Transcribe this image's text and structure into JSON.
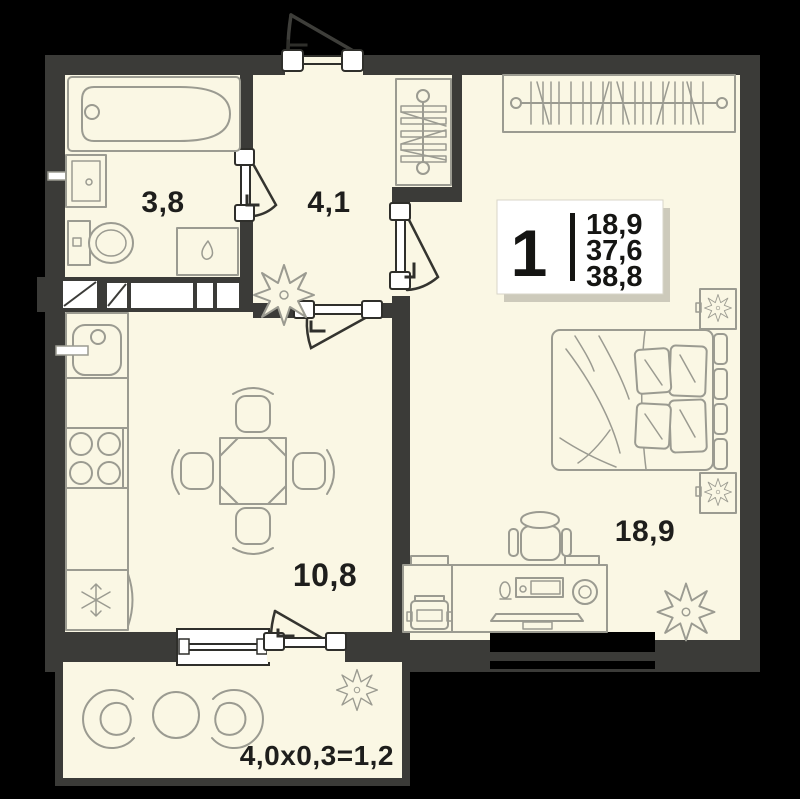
{
  "rooms": {
    "bathroom": {
      "name": "bathroom",
      "area": "3,8"
    },
    "hallway": {
      "name": "hallway",
      "area": "4,1"
    },
    "kitchen_living": {
      "name": "kitchen-living-room",
      "area": "10,8"
    },
    "bedroom": {
      "name": "bedroom",
      "area": "18,9"
    }
  },
  "balcony": {
    "dimensions_label": "4,0x0,3=1,2"
  },
  "info_card": {
    "room_count": "1",
    "values": [
      "18,9",
      "37,6",
      "38,8"
    ]
  },
  "icons": {
    "fridge": "snowflake-icon",
    "washing_machine": "water-drop-icon",
    "plants": "flower-star-icon"
  },
  "colors": {
    "background": "#000000",
    "wall": "#3B3B38",
    "floor": "#FAF7E4",
    "furniture_outline": "#9B9B91",
    "label_text": "#1E1E1C",
    "card_background": "#FFFFFF"
  }
}
